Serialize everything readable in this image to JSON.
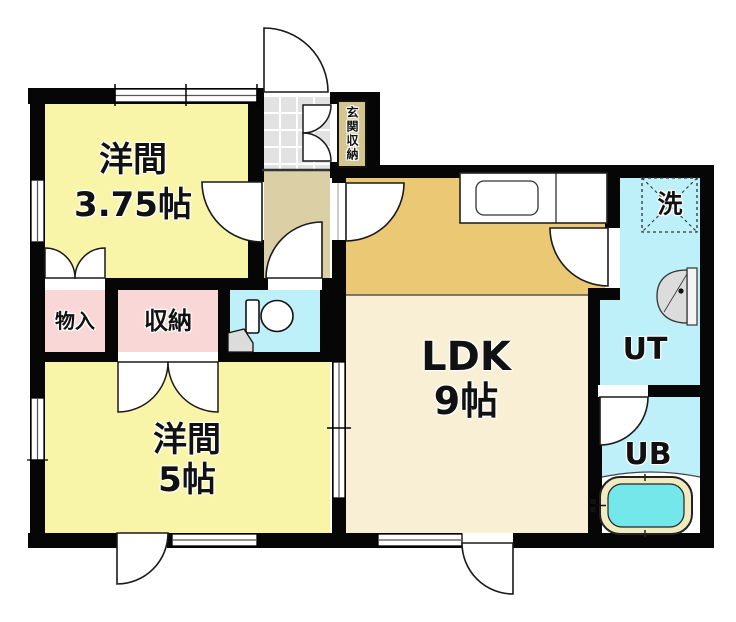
{
  "plan_title": "1LDK+2室 間取り図",
  "rooms": {
    "western_a": {
      "name": "洋間",
      "size": "3.75帖",
      "color": "#f8f5a9"
    },
    "western_b": {
      "name": "洋間",
      "size": "5帖",
      "color": "#f8f5a9"
    },
    "ldk": {
      "name": "LDK",
      "size": "9帖",
      "color": "#f8efd5"
    },
    "kitchen_area": {
      "color": "#ebc974"
    },
    "storage": {
      "name": "物入",
      "color": "#f9d7d6"
    },
    "closet": {
      "name": "収納",
      "color": "#f9d7d6"
    },
    "toilet": {
      "color": "#bdf0f8"
    },
    "utility": {
      "name": "UT",
      "color": "#bdf0f8"
    },
    "unit_bath": {
      "name": "UB",
      "color": "#bdf0f8"
    },
    "entrance_storage": {
      "name": "玄関収納",
      "color": "#d4c48d"
    },
    "hallway": {
      "color": "#dbcfa5"
    },
    "entrance": {
      "color": "#e2e2e2"
    }
  },
  "fixtures": {
    "washing_machine_label": "洗",
    "bathtub_water_color": "#74e7ea",
    "bathtub_rim_color": "#f1ebc0"
  },
  "wall_color": "#060606"
}
